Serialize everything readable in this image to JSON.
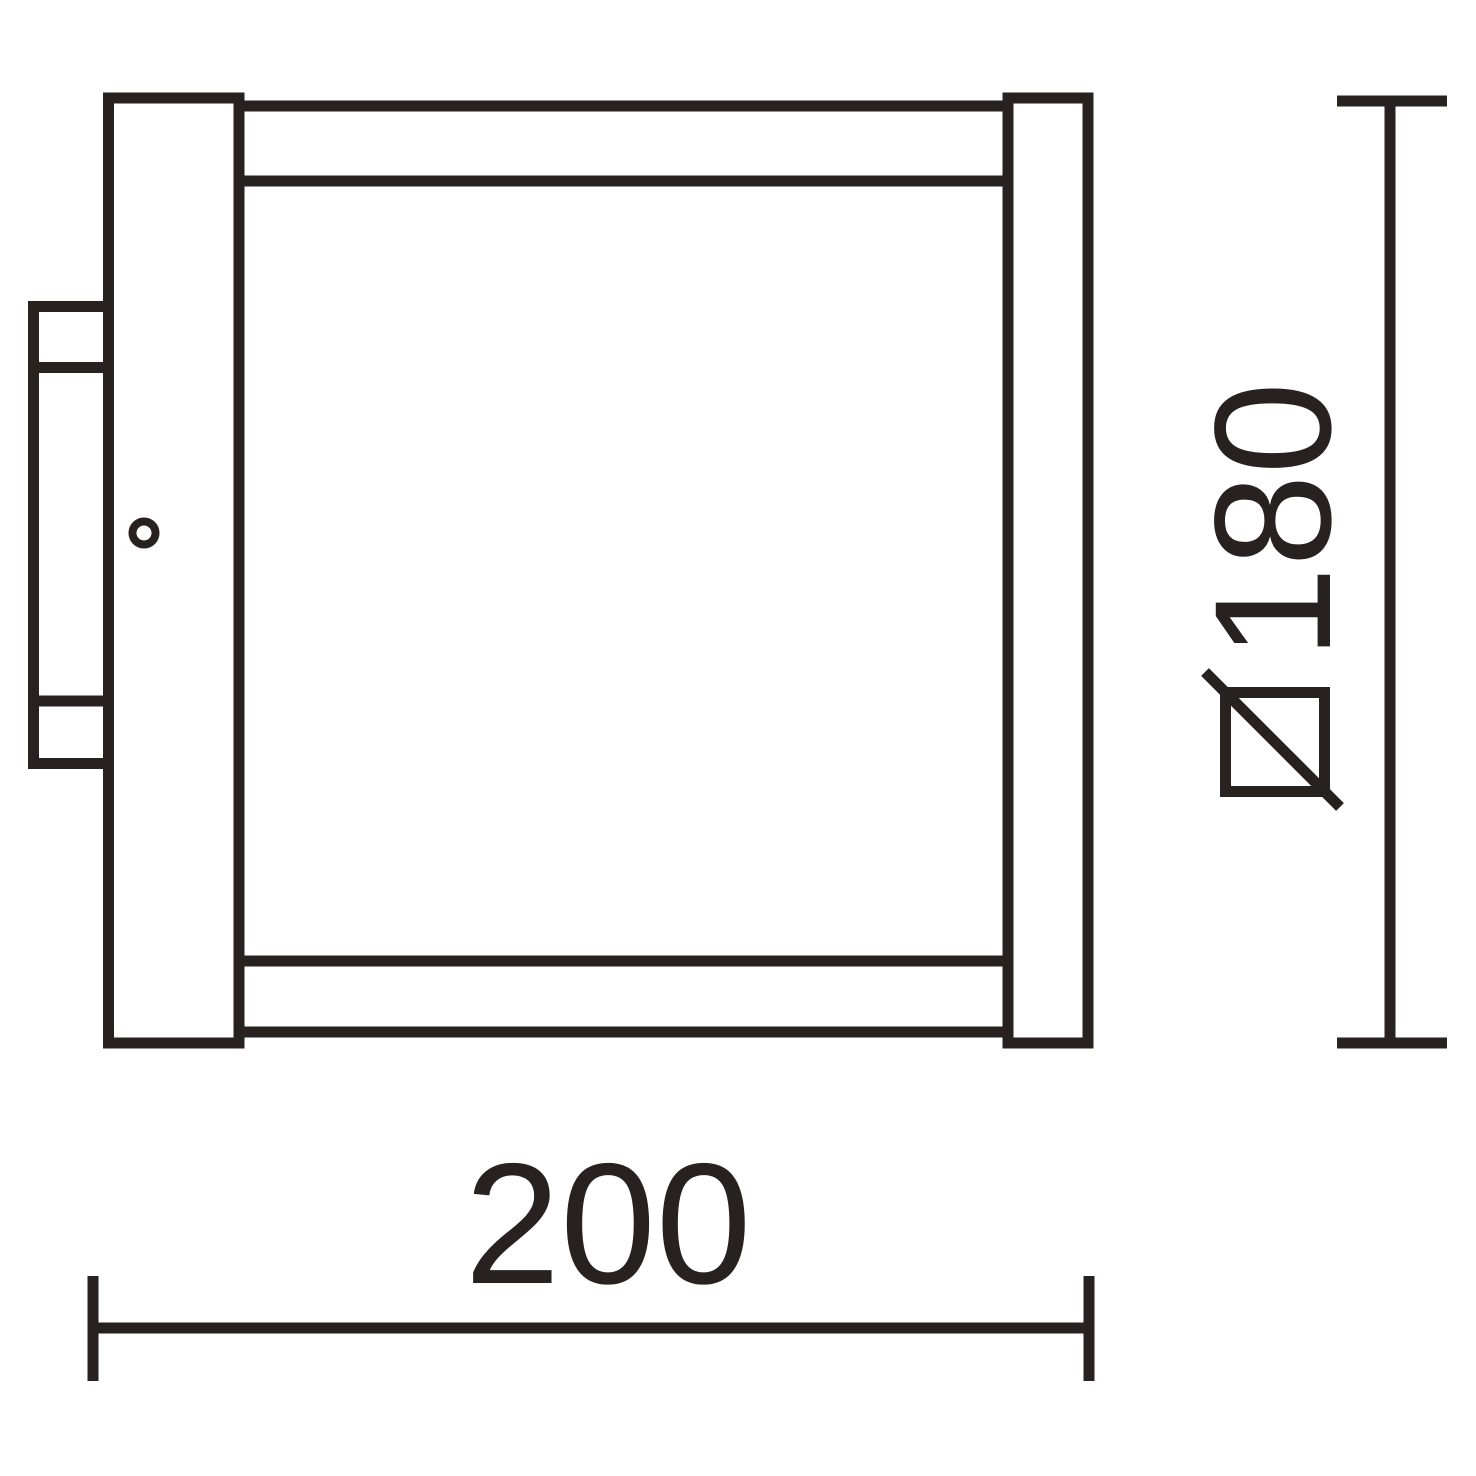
{
  "drawing": {
    "kind": "technical-dimension-drawing",
    "colors": {
      "ink": "#272220",
      "background": "#ffffff"
    },
    "width_dimension": {
      "value": "200"
    },
    "height_dimension": {
      "value": "180",
      "symbol_icon": "square-section-icon"
    }
  }
}
